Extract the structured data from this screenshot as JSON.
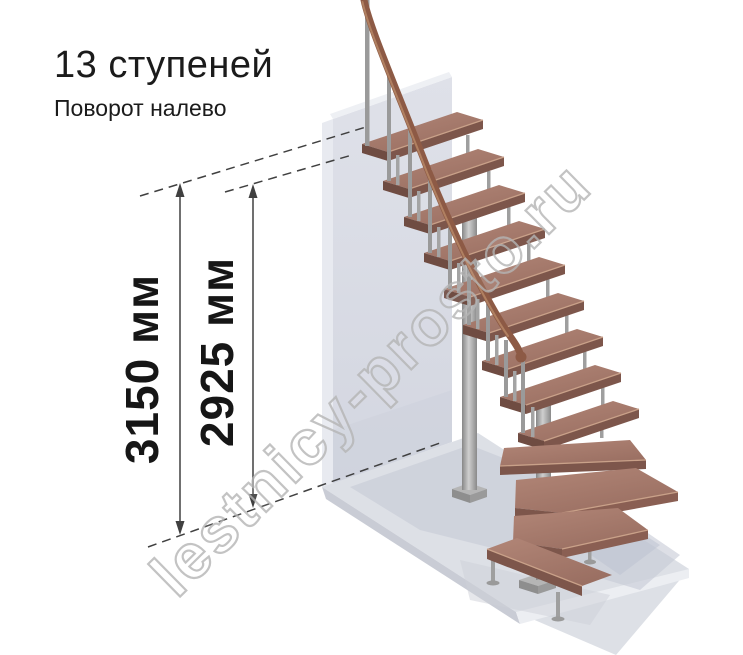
{
  "title": {
    "text": "13 ступеней"
  },
  "subtitle": {
    "text": "Поворот налево"
  },
  "dimensions": {
    "total_height": {
      "value": 3150,
      "unit": "мм",
      "label": "3150 мм"
    },
    "flight_height": {
      "value": 2925,
      "unit": "мм",
      "label": "2925 мм"
    }
  },
  "watermark": {
    "text": "lestnicy-prosto.ru"
  },
  "figure": {
    "kind": "staircase-3d-render",
    "steps_count": 13,
    "turn_direction": "налево",
    "straight_treads": 9,
    "winder_treads": 3,
    "bottom_step": 1
  },
  "colors": {
    "text": "#1b1b1b",
    "dimension_lines": "#404040",
    "wood_tread": "#a87c6e",
    "tread_front": "#7d564b",
    "nosing": "#c9a189",
    "handrail": "#8d5a45",
    "metal": "#a0a0a0",
    "wall": "#d9dbe4",
    "floor": "#dde0e6",
    "watermark": "#b5b5b5"
  }
}
